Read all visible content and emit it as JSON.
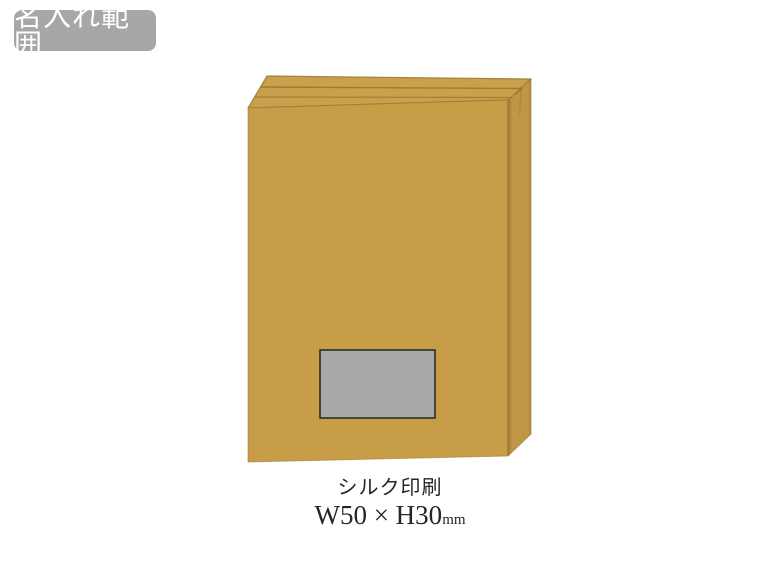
{
  "page": {
    "background": "#ffffff"
  },
  "badge": {
    "label": "名入れ範囲",
    "bg_color": "#a7a7a7",
    "text_color": "#ffffff"
  },
  "product": {
    "description": "tan-gift-box",
    "top_color": "#c9a04b",
    "front_color": "#c79d48",
    "side_color": "#c09645",
    "seam_color": "#9b7834",
    "side_edge_color": "#b28a3e",
    "edge_color": "#98772f",
    "crease_color": "#9a7733",
    "print_area": {
      "fill": "#a9a9a9",
      "border": "#1b1b1b"
    }
  },
  "caption": {
    "method": "シルク印刷",
    "size_main": "W50 × H30",
    "size_unit": "mm",
    "text_color": "#262626"
  }
}
